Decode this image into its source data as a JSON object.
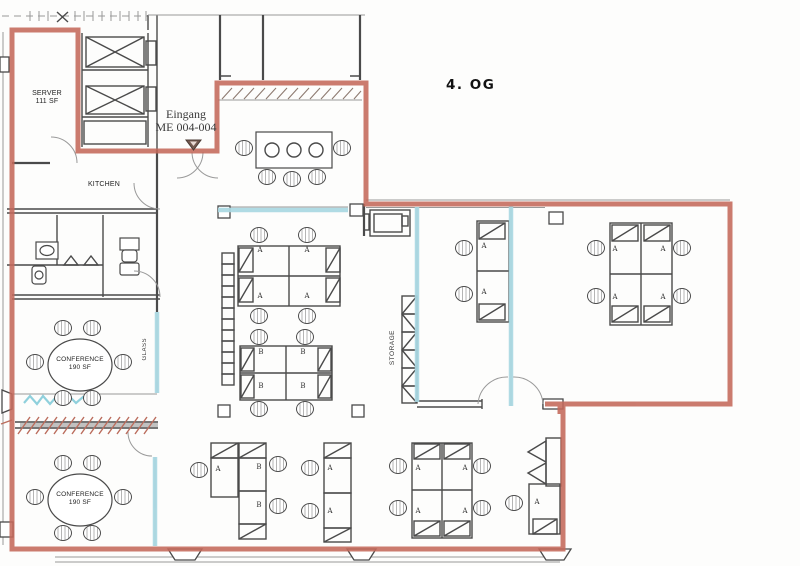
{
  "floor_label": "4. OG",
  "entrance": {
    "line1": "Eingang",
    "line2": "ME 004-004"
  },
  "rooms": {
    "server": {
      "line1": "SERVER",
      "line2": "111 SF"
    },
    "kitchen": "KITCHEN",
    "conference_upper": {
      "line1": "CONFERENCE",
      "line2": "190 SF"
    },
    "conference_lower": {
      "line1": "CONFERENCE",
      "line2": "190 SF"
    },
    "storage": "STORAGE",
    "glass_partition": "GLASS"
  },
  "desk_labels": {
    "a": "A",
    "b": "B"
  },
  "colors": {
    "markup_red": "#c4695a",
    "markup_blue": "#a9d8e2",
    "wall": "#4a4a4a",
    "background": "#fdfdfc"
  }
}
